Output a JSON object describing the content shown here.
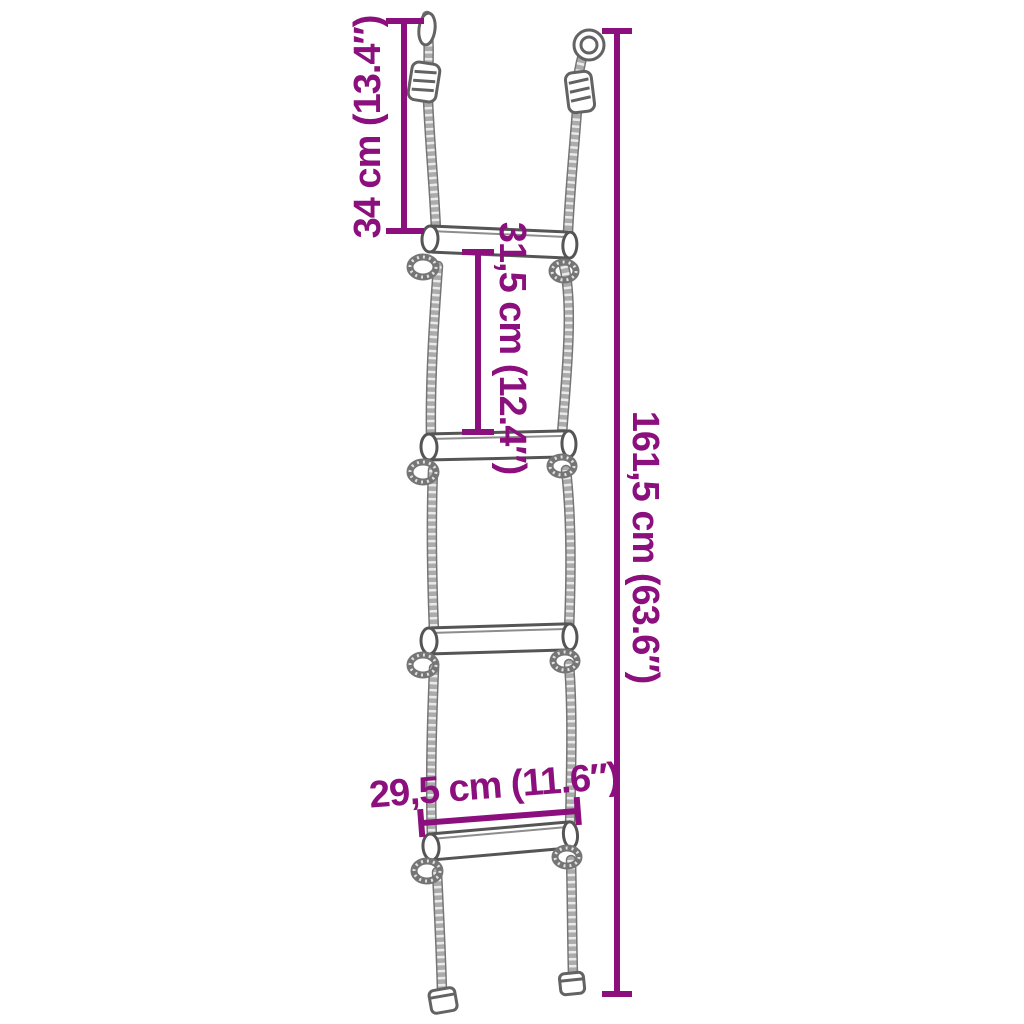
{
  "colors": {
    "accent": "#8B107D",
    "rope": "#ababab",
    "rope_outline": "#757575",
    "hardware": "#636363",
    "rung_outline": "#555555",
    "background": "#ffffff"
  },
  "diagram": {
    "subject": "rope ladder with 4 rungs, hanging hardware and dimension annotations",
    "dimensions": {
      "hanger_to_first_rung": {
        "label": "34 cm (13.4″)",
        "orientation": "vertical-ccw"
      },
      "rung_spacing": {
        "label": "31,5 cm (12.4″)",
        "orientation": "vertical-cw"
      },
      "total_length": {
        "label": "161,5 cm (63.6″)",
        "orientation": "vertical-cw"
      },
      "rung_width": {
        "label": "29,5 cm (11.6″)",
        "orientation": "horizontal"
      }
    }
  }
}
